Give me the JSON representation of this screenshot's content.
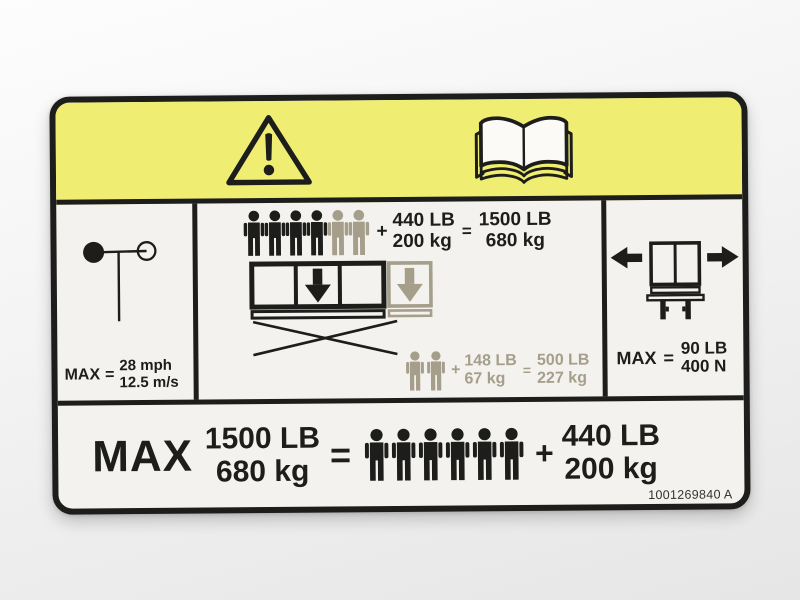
{
  "colors": {
    "black": "#1d1d1b",
    "gray": "#a59e8a",
    "yellow": "#f0ee72",
    "paper": "#f4f2ee",
    "page": "#fbfaf7"
  },
  "header": {
    "warning_icon": "warning-triangle",
    "manual_icon": "read-operator-manual-book"
  },
  "wind": {
    "max": "MAX",
    "eq": "=",
    "speed_mph": "28 mph",
    "speed_ms": "12.5 m/s"
  },
  "capacity": {
    "main": {
      "persons": [
        "black",
        "black",
        "black",
        "black",
        "gray",
        "gray"
      ],
      "plus": "+",
      "extra_lb": "440 LB",
      "extra_kg": "200 kg",
      "eq": "=",
      "total_lb": "1500 LB",
      "total_kg": "680 kg"
    },
    "extension": {
      "persons": [
        "gray",
        "gray"
      ],
      "plus": "+",
      "extra_lb": "148 LB",
      "extra_kg": "67 kg",
      "eq": "=",
      "total_lb": "500 LB",
      "total_kg": "227 kg"
    }
  },
  "side_force": {
    "max": "MAX",
    "eq": "=",
    "force_lb": "90 LB",
    "force_n": "400 N"
  },
  "total": {
    "max": "MAX",
    "total_lb": "1500 LB",
    "total_kg": "680 kg",
    "eq": "=",
    "persons": [
      "black",
      "black",
      "black",
      "black",
      "black",
      "black"
    ],
    "plus": "+",
    "extra_lb": "440 LB",
    "extra_kg": "200 kg"
  },
  "part_number": "1001269840 A"
}
